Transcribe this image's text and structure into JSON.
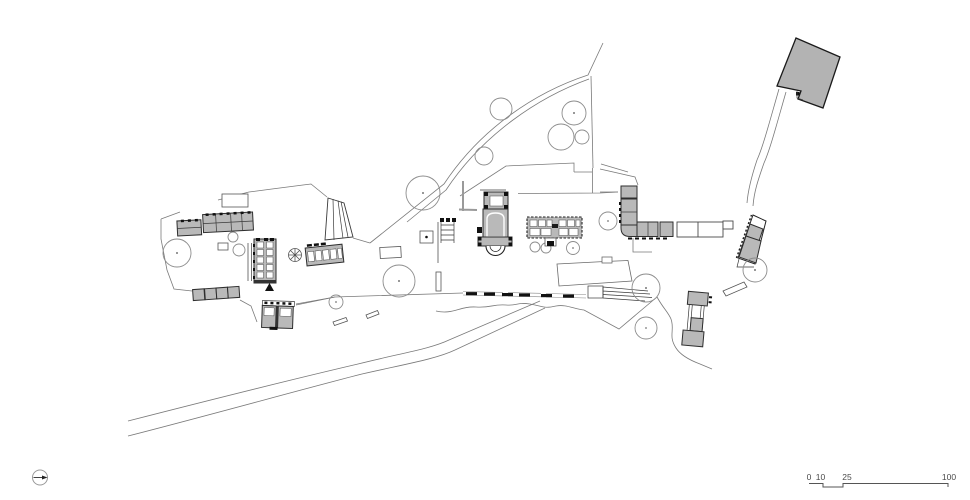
{
  "drawing": {
    "type": "architectural-site-plan",
    "scale_bar": {
      "labels": [
        "0",
        "10",
        "25",
        "100"
      ]
    },
    "icons": {
      "north_arrow": "circle-with-needle-pointing-right"
    },
    "colors": {
      "bg": "#ffffff",
      "bfill": "#b9b9b9",
      "bstroke": "#2e2e2e",
      "site": "#7a7a7a",
      "tree": "#8c8c8c",
      "label": "#4a4a4a"
    }
  }
}
